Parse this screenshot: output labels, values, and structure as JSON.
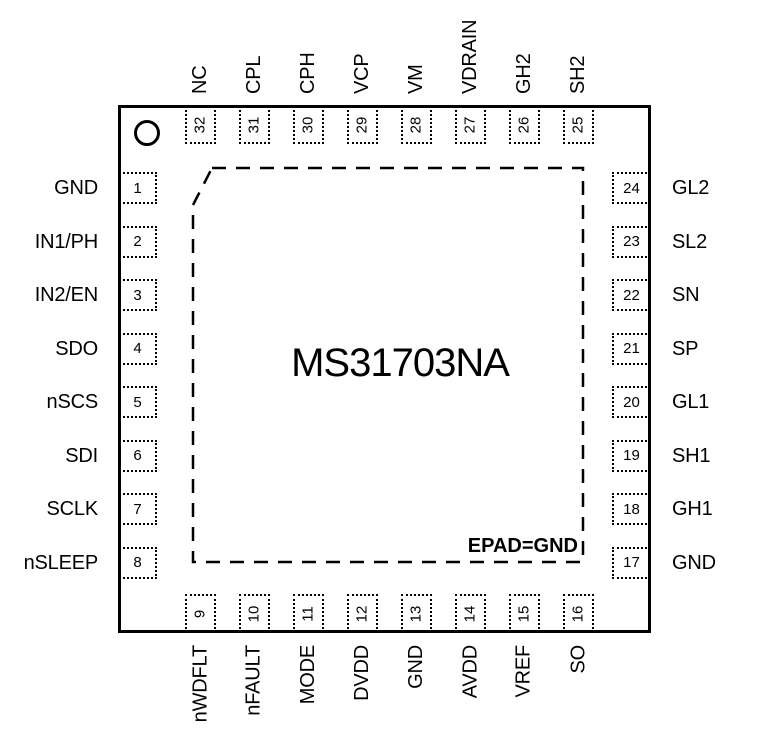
{
  "diagram": {
    "title": "MS31703NA",
    "epad_label": "EPAD=GND",
    "package_pin_count": 32
  },
  "colors": {
    "line": "#000000",
    "text": "#000000",
    "background": "#ffffff"
  },
  "pins": {
    "top": [
      {
        "number": 32,
        "name": "NC"
      },
      {
        "number": 31,
        "name": "CPL"
      },
      {
        "number": 30,
        "name": "CPH"
      },
      {
        "number": 29,
        "name": "VCP"
      },
      {
        "number": 28,
        "name": "VM"
      },
      {
        "number": 27,
        "name": "VDRAIN"
      },
      {
        "number": 26,
        "name": "GH2"
      },
      {
        "number": 25,
        "name": "SH2"
      }
    ],
    "left": [
      {
        "number": 1,
        "name": "GND"
      },
      {
        "number": 2,
        "name": "IN1/PH"
      },
      {
        "number": 3,
        "name": "IN2/EN"
      },
      {
        "number": 4,
        "name": "SDO"
      },
      {
        "number": 5,
        "name": "nSCS"
      },
      {
        "number": 6,
        "name": "SDI"
      },
      {
        "number": 7,
        "name": "SCLK"
      },
      {
        "number": 8,
        "name": "nSLEEP"
      }
    ],
    "right": [
      {
        "number": 24,
        "name": "GL2"
      },
      {
        "number": 23,
        "name": "SL2"
      },
      {
        "number": 22,
        "name": "SN"
      },
      {
        "number": 21,
        "name": "SP"
      },
      {
        "number": 20,
        "name": "GL1"
      },
      {
        "number": 19,
        "name": "SH1"
      },
      {
        "number": 18,
        "name": "GH1"
      },
      {
        "number": 17,
        "name": "GND"
      }
    ],
    "bottom": [
      {
        "number": 9,
        "name": "nWDFLT"
      },
      {
        "number": 10,
        "name": "nFAULT"
      },
      {
        "number": 11,
        "name": "MODE"
      },
      {
        "number": 12,
        "name": "DVDD"
      },
      {
        "number": 13,
        "name": "GND"
      },
      {
        "number": 14,
        "name": "AVDD"
      },
      {
        "number": 15,
        "name": "VREF"
      },
      {
        "number": 16,
        "name": "SO"
      }
    ]
  }
}
